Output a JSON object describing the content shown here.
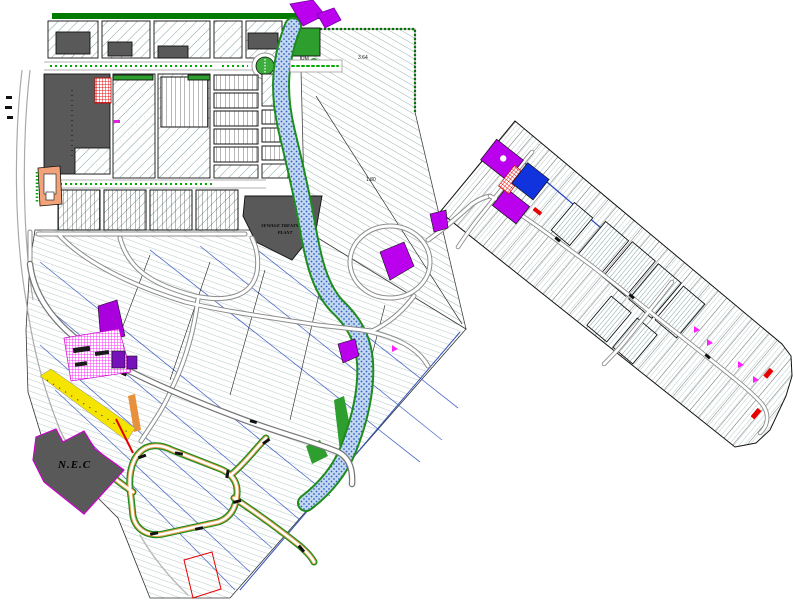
{
  "labels": {
    "sewage_line1": "SEWAGE TREATMENT",
    "sewage_line2": "PLANT",
    "nec": "N.E.C",
    "parcel_area_top": "3.64",
    "parcel_area_mid": "UM",
    "parcel_area_bottom": "1.80"
  },
  "palette": {
    "background": "#FFFFFF",
    "block_hatch": "#7FA0A0",
    "lot_hatch": "#A3BABA",
    "building_gray": "#595959",
    "landscape_green": "#1E8C1E",
    "band_green": "#007A00",
    "roundabout_green": "#3DAE3D",
    "river_dot_blue": "#2E5FC4",
    "river_bg_blue": "#C4D8F0",
    "plot_purple": "#BB00EE",
    "plot_dark_purple": "#7711BB",
    "checker_magenta": "#FF22FF",
    "plot_blue": "#1133DD",
    "alert_red": "#E60000",
    "strip_yellow": "#F5E400",
    "building_peach": "#F2A278",
    "road_gray": "#8C8C8C",
    "boundary_blue": "#3355BB",
    "road_edge_orange": "#E8A050"
  }
}
